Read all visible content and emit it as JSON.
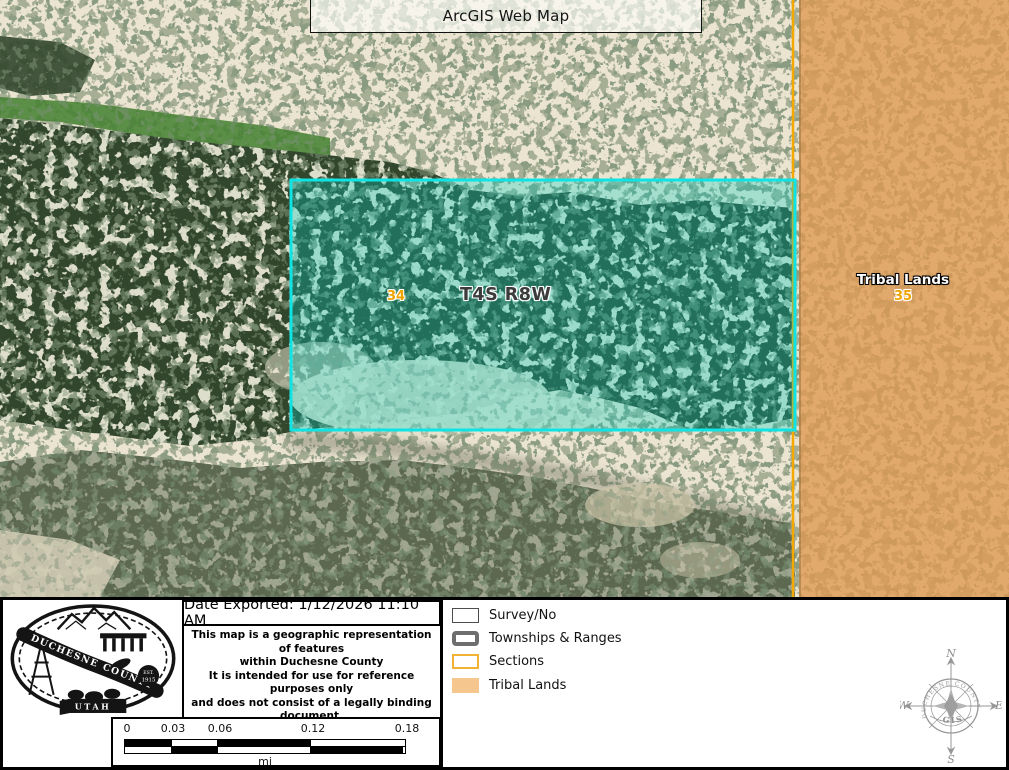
{
  "title": "ArcGIS Web Map",
  "map": {
    "section_left": "34",
    "township_label": "T4S R8W",
    "tribal_label": "Tribal Lands",
    "section_right": "35"
  },
  "panel": {
    "date_exported": "Date Exported: 1/12/2026 11:10 AM",
    "disclaimer": [
      "This map is a geographic representation of features",
      "within Duchesne County",
      "It is intended for use for reference purposes only",
      "and does not consist of a legally binding document.",
      "User assumes all risk."
    ],
    "address": [
      "734 North Center ST",
      "Duchesne, UT 84021",
      "435-738-1168"
    ],
    "legend": {
      "items": [
        {
          "label": "Survey/No"
        },
        {
          "label": "Townships & Ranges"
        },
        {
          "label": "Sections"
        },
        {
          "label": "Tribal Lands"
        }
      ]
    },
    "scalebar": {
      "ticks": [
        "0",
        "0.03",
        "0.06",
        "0.12",
        "0.18"
      ],
      "unit": "mi"
    },
    "logo": {
      "county": "DUCHESNE COUNTY",
      "state": "UTAH",
      "est_line1": "EST.",
      "est_line2": "1915"
    },
    "compass": {
      "title": "DUCHESNE COUNTY",
      "sub": "GIS",
      "n": "N",
      "s": "S",
      "e": "E",
      "w": "W"
    }
  },
  "colors": {
    "parcel_outline": "#0fe3e3",
    "section_line": "#f5a800",
    "tribal_fill": "#e09a52",
    "section_label": "#f0a400",
    "legend_sections_outline": "#f2b233",
    "legend_townships_outline": "#6e6e6e",
    "legend_tribal_fill": "#f6c68f"
  }
}
